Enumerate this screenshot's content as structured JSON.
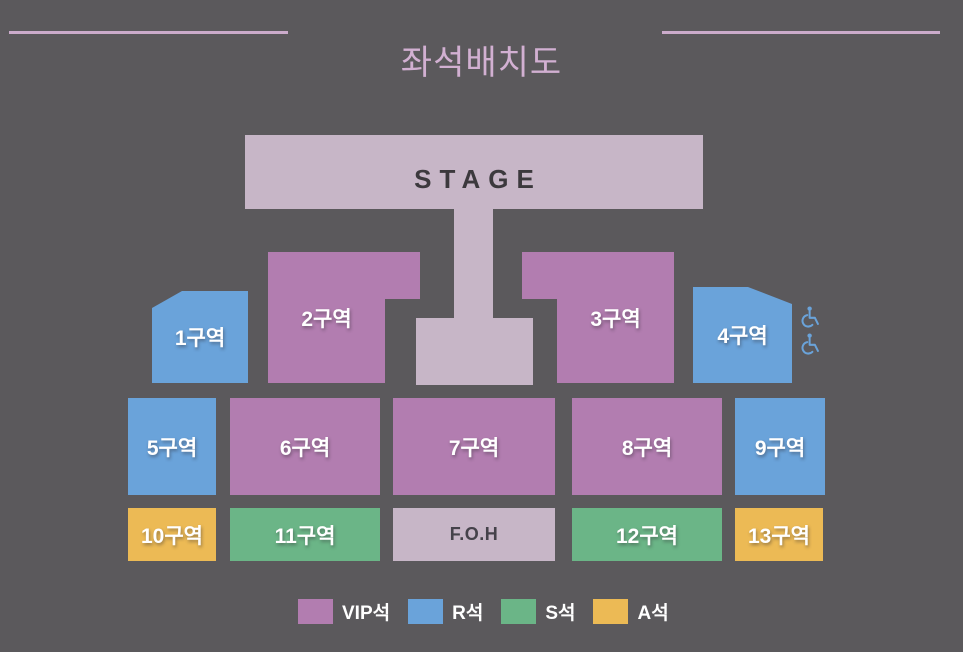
{
  "title": "좌석배치도",
  "stage": {
    "label": "STAGE"
  },
  "foh": {
    "label": "F.O.H"
  },
  "sections": [
    {
      "id": "1",
      "label": "1구역",
      "grade": "R석"
    },
    {
      "id": "2",
      "label": "2구역",
      "grade": "VIP석"
    },
    {
      "id": "3",
      "label": "3구역",
      "grade": "VIP석"
    },
    {
      "id": "4",
      "label": "4구역",
      "grade": "R석"
    },
    {
      "id": "5",
      "label": "5구역",
      "grade": "R석"
    },
    {
      "id": "6",
      "label": "6구역",
      "grade": "VIP석"
    },
    {
      "id": "7",
      "label": "7구역",
      "grade": "VIP석"
    },
    {
      "id": "8",
      "label": "8구역",
      "grade": "VIP석"
    },
    {
      "id": "9",
      "label": "9구역",
      "grade": "R석"
    },
    {
      "id": "10",
      "label": "10구역",
      "grade": "A석"
    },
    {
      "id": "11",
      "label": "11구역",
      "grade": "S석"
    },
    {
      "id": "12",
      "label": "12구역",
      "grade": "S석"
    },
    {
      "id": "13",
      "label": "13구역",
      "grade": "A석"
    }
  ],
  "accessibility": {
    "icon": "wheelchair-icon",
    "count": 2
  },
  "legend": [
    {
      "label": "VIP석",
      "color": "#b27db0"
    },
    {
      "label": "R석",
      "color": "#6aa3da"
    },
    {
      "label": "S석",
      "color": "#6bb587"
    },
    {
      "label": "A석",
      "color": "#ecba55"
    }
  ],
  "colors": {
    "background": "#5b595c",
    "stage_area": "#c7b6c7",
    "title_accent": "#d2b0d2",
    "vip": "#b27db0",
    "r": "#6aa3da",
    "s": "#6bb587",
    "a": "#ecba55"
  }
}
